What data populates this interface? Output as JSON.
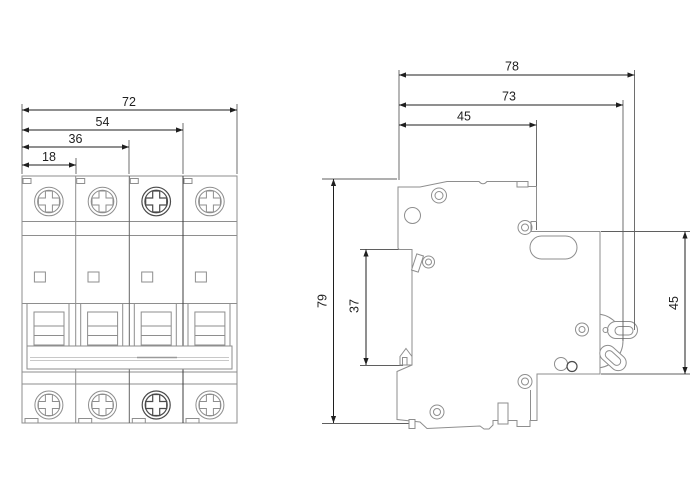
{
  "front_view": {
    "dims": {
      "overall_width": "72",
      "three_poles": "54",
      "two_poles": "36",
      "one_pole": "18"
    },
    "pole_count": 4
  },
  "side_view": {
    "dims": {
      "overall_depth": "78",
      "body_depth": "73",
      "upper_depth": "45",
      "height": "79",
      "rail_recess": "37",
      "front_height": "45"
    }
  },
  "colors": {
    "background": "#ffffff",
    "outline": "#8e8e8e",
    "outline_dark": "#4a4a4a",
    "dimension": "#1f1f1f",
    "light_detail": "#c8c8c8"
  }
}
